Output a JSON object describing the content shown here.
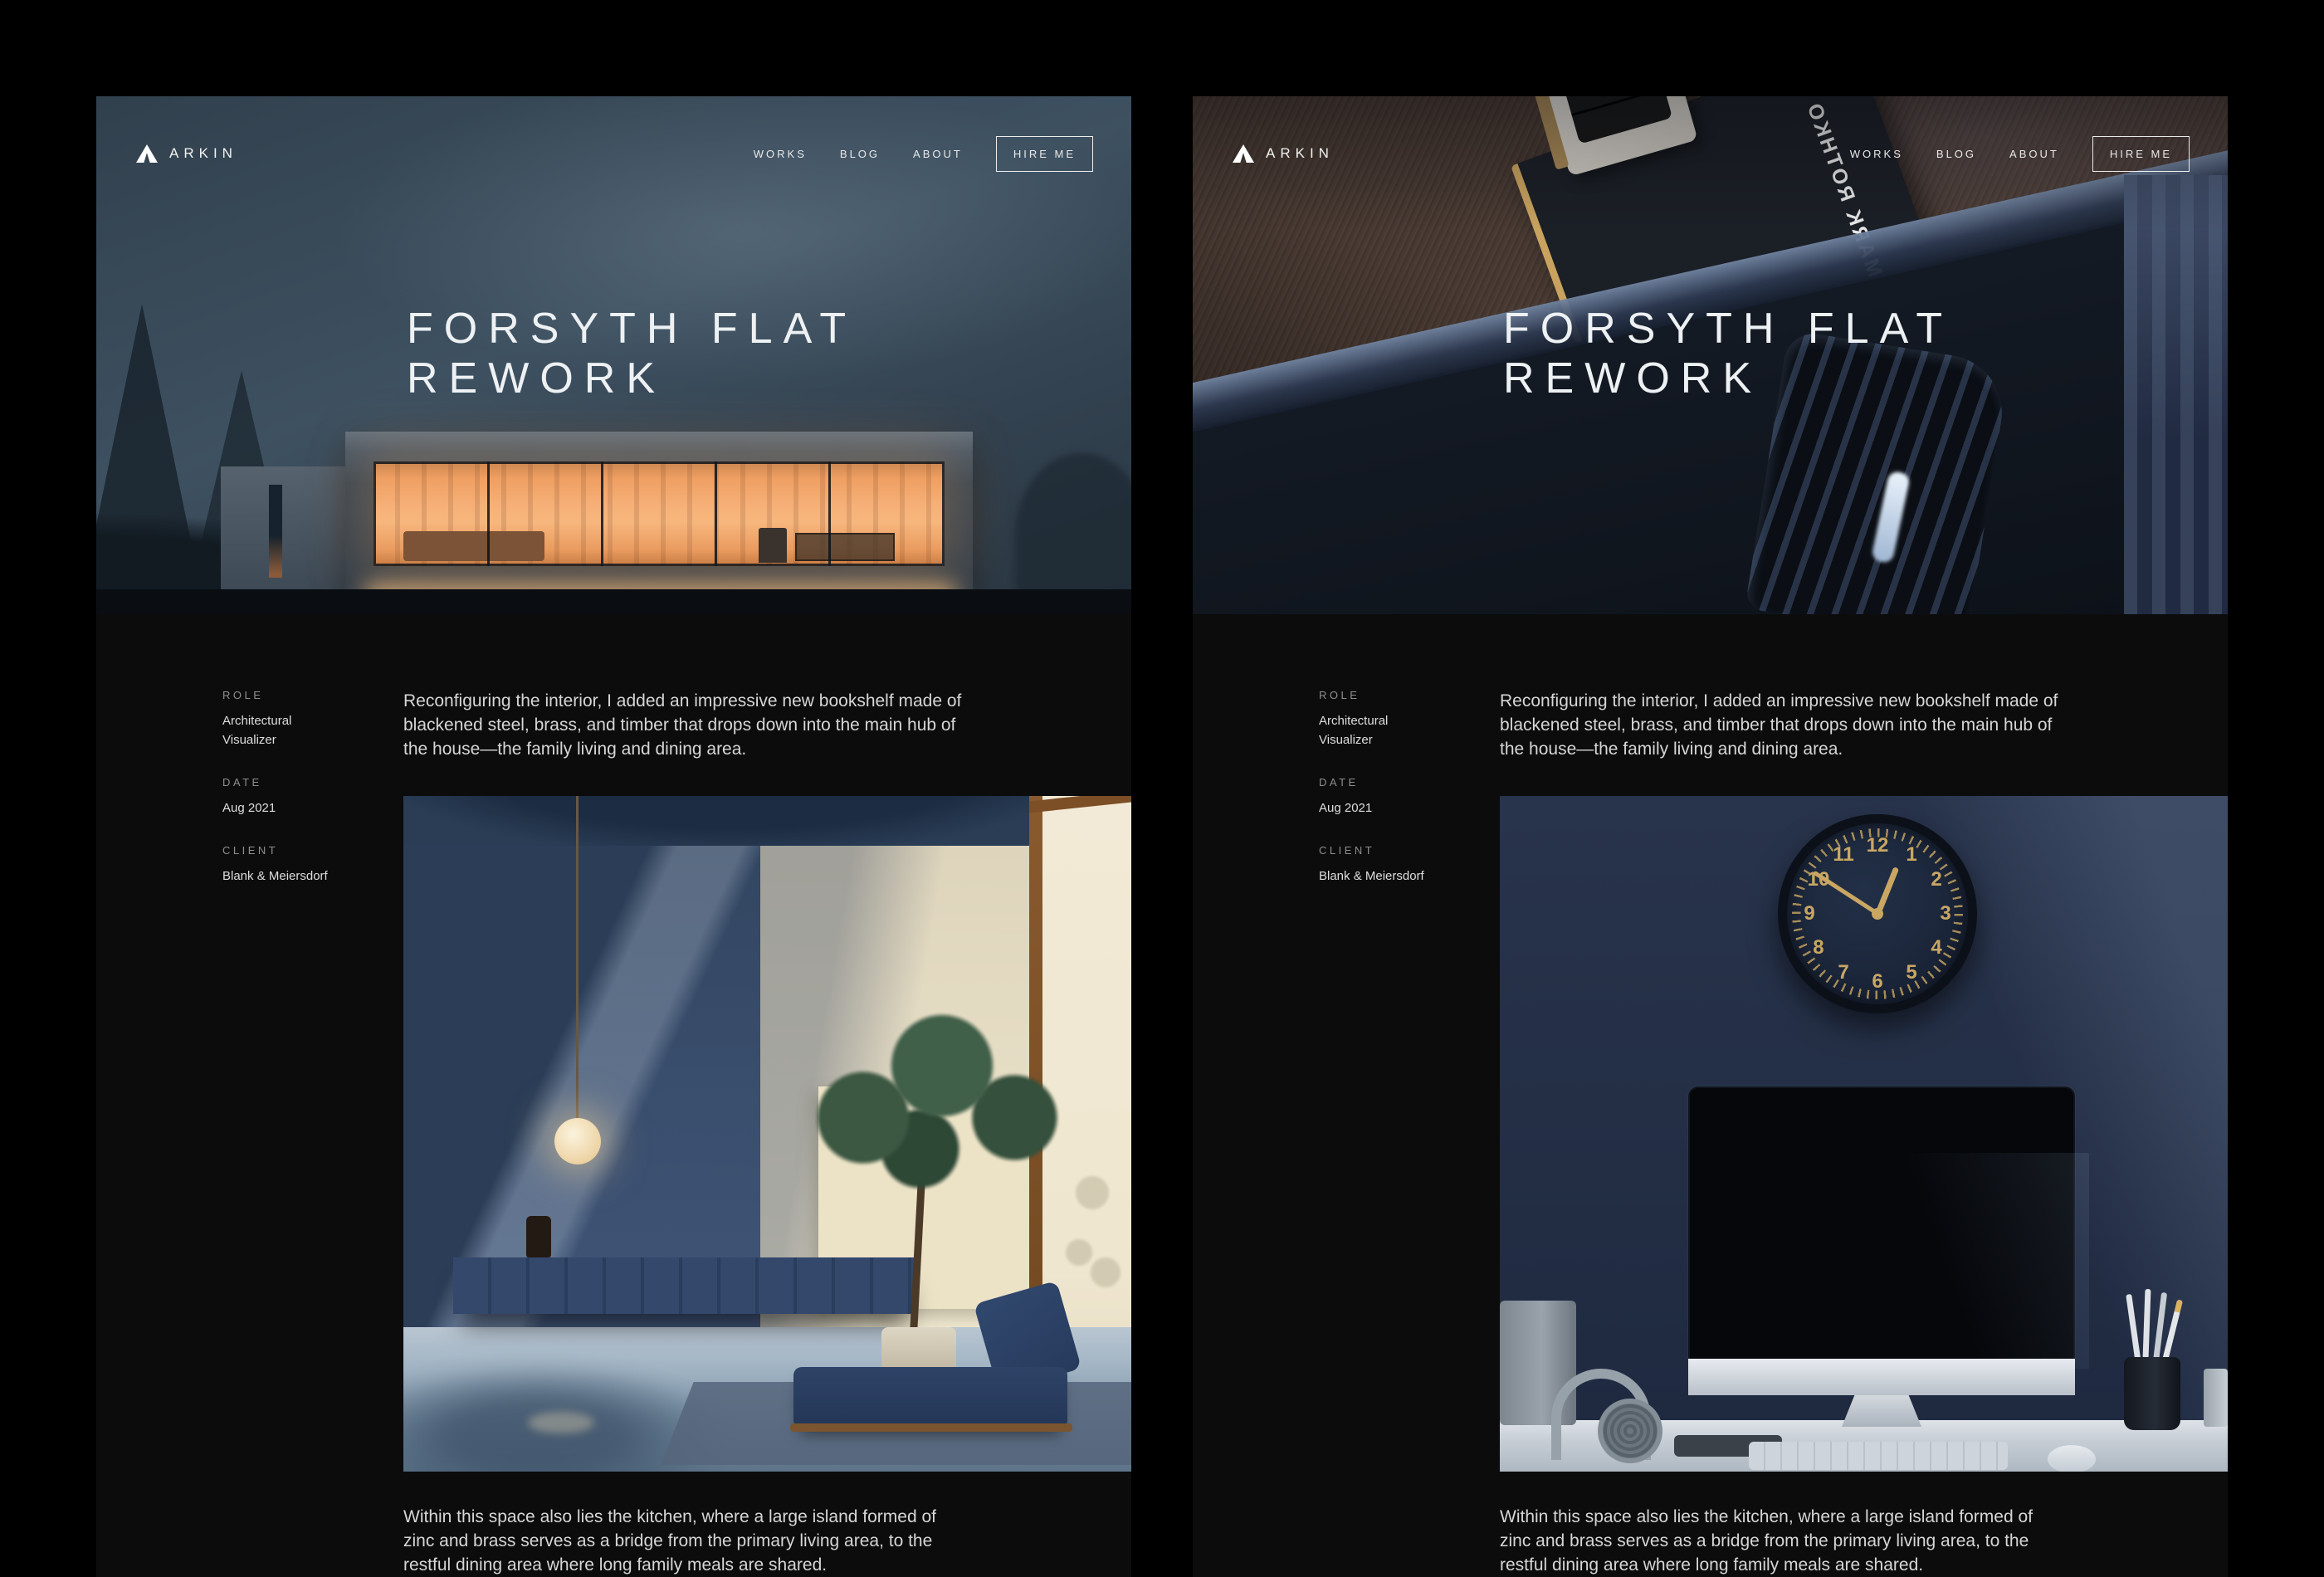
{
  "brand": {
    "name": "ARKIN"
  },
  "nav": {
    "items": [
      "WORKS",
      "BLOG",
      "ABOUT"
    ],
    "hire_label": "HIRE ME"
  },
  "project": {
    "title_line1": "FORSYTH FLAT",
    "title_line2": "REWORK",
    "meta": [
      {
        "label": "ROLE",
        "value": "Architectural Visualizer"
      },
      {
        "label": "DATE",
        "value": "Aug 2021"
      },
      {
        "label": "CLIENT",
        "value": "Blank & Meiersdorf"
      }
    ],
    "paragraph1": "Reconfiguring the interior, I added an impressive new bookshelf made of blackened steel, brass, and timber that drops down into the main hub of the house—the family living and dining area.",
    "paragraph2": "Within this space also lies the kitchen, where a large island formed of zinc and brass serves as a bridge from the primary living area, to the restful dining area where long family meals are shared."
  },
  "hero_right": {
    "book_title": "MARK ROTHKO"
  },
  "clock": {
    "numerals": [
      "12",
      "1",
      "2",
      "3",
      "4",
      "5",
      "6",
      "7",
      "8",
      "9",
      "10",
      "11"
    ]
  },
  "colors": {
    "frame_background": "#000000",
    "page_background": "#0c0c0c",
    "text_primary": "#eceff1",
    "text_secondary": "#8f8f8f",
    "body_text": "#d6d6d6",
    "hero_glow": "#f2a868",
    "clock_gold": "#c9a763"
  }
}
